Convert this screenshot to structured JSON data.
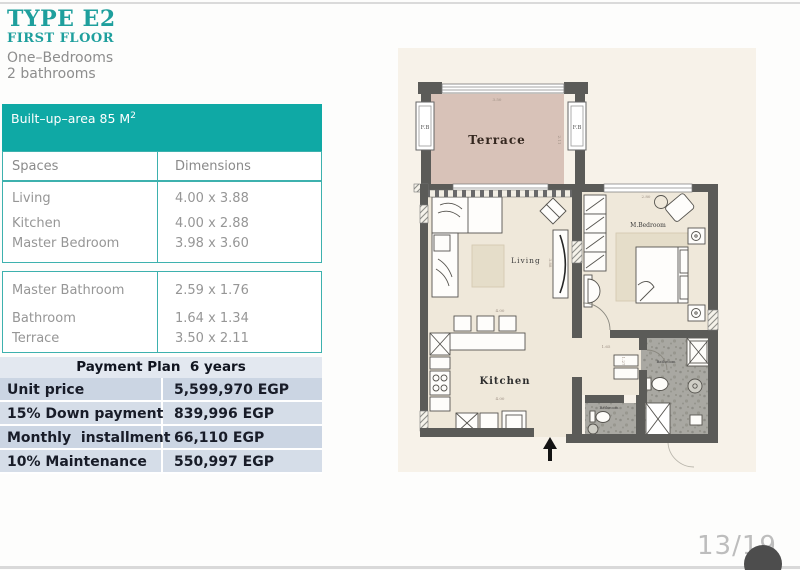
{
  "header": {
    "type_title": "TYPE E2",
    "floor_title": "FIRST FLOOR",
    "bedrooms_line": "One–Bedrooms",
    "bathrooms_line": "2 bathrooms"
  },
  "area_banner": {
    "label": "Built–up–area 85 M",
    "sup": "2"
  },
  "spaces_table": {
    "columns": [
      "Spaces",
      "Dimensions"
    ],
    "groups": [
      {
        "rows": [
          {
            "space": "Living",
            "dim": "4.00 x 3.88"
          },
          {
            "space": "Kitchen",
            "dim": "4.00 x 2.88"
          },
          {
            "space": "Master Bedroom",
            "dim": "3.98 x 3.60"
          }
        ]
      },
      {
        "rows": [
          {
            "space": "Master Bathroom",
            "dim": "2.59 x 1.76"
          },
          {
            "space": "Bathroom",
            "dim": "1.64 x 1.34"
          },
          {
            "space": "Terrace",
            "dim": "3.50 x 2.11"
          }
        ]
      }
    ]
  },
  "payment_plan": {
    "title": "Payment Plan  6 years",
    "rows": [
      {
        "label": "Unit price",
        "value": "5,599,970 EGP"
      },
      {
        "label": "15% Down payment",
        "value": "839,996 EGP"
      },
      {
        "label": "Monthly  installment",
        "value": "66,110 EGP"
      },
      {
        "label": "10% Maintenance",
        "value": "550,997 EGP"
      }
    ]
  },
  "floor_plan": {
    "labels": {
      "terrace": "Terrace",
      "living": "Living",
      "kitchen": "Kitchen",
      "bedroom": "M.Bedroom",
      "bathroom1": "Bathroom",
      "bathroom2": "Bathroom",
      "fb_left": "F.B",
      "fb_right": "F.B"
    },
    "dims": {
      "terrace_w": "3.50",
      "terrace_d": "2.11",
      "living_w": "4.00",
      "living_d": "3.88",
      "kitchen_w": "4.00",
      "bedroom_w": "2.80",
      "hall_w": "1.65",
      "hall_d": "1.27"
    }
  },
  "page_indicator": "13/19",
  "colors": {
    "teal": "#0fa9a5",
    "payment_row": "#cbd5e3",
    "terrace_floor": "#d8c2b8",
    "room_floor": "#efe8da",
    "bath_floor": "#a9a8a2"
  }
}
